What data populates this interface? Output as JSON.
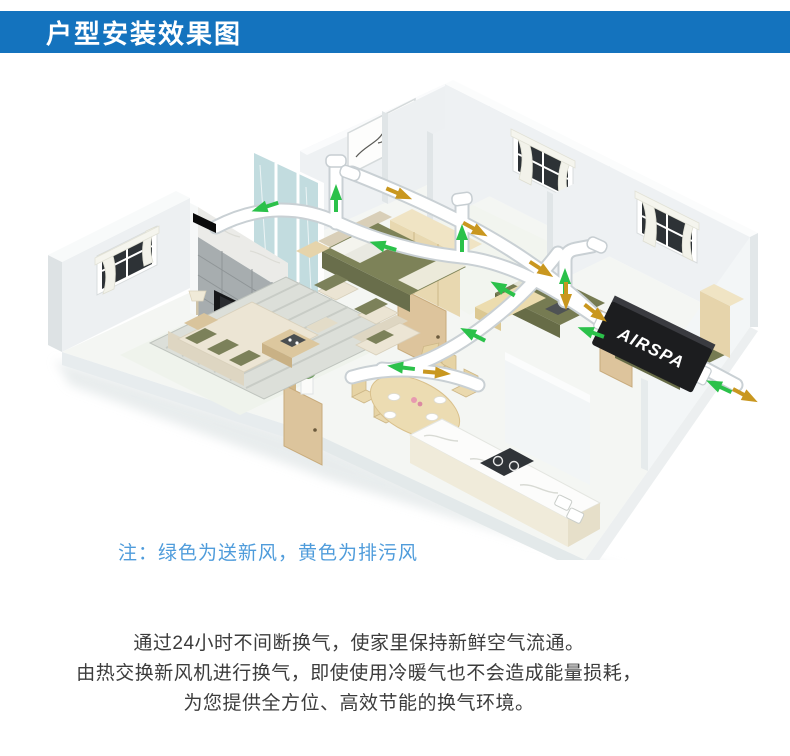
{
  "header": {
    "title": "户型安装效果图",
    "bg_color": "#1473be",
    "text_color": "#ffffff"
  },
  "illustration": {
    "type": "isometric-apartment-ventilation-cutaway",
    "unit_label": "AIRSPA",
    "airflow_legend": {
      "fresh_air": {
        "meaning": "送新风",
        "color": "#2bc14a"
      },
      "exhaust_air": {
        "meaning": "排污风",
        "color": "#c9971f"
      }
    }
  },
  "note": {
    "text": "注：绿色为送新风，黄色为排污风",
    "color": "#4f9cdb"
  },
  "description": {
    "lines": [
      "通过24小时不间断换气，使家里保持新鲜空气流通。",
      "由热交换新风机进行换气，即使使用冷暖气也不会造成能量损耗，",
      "为您提供全方位、高效节能的换气环境。"
    ],
    "color": "#3c3c3c"
  },
  "colors": {
    "header_blue": "#1473be",
    "note_blue": "#4f9cdb",
    "fresh_air_green": "#2bc14a",
    "exhaust_yellow": "#c9971f",
    "wall": "#eef1f3",
    "floor": "#f4f6f3",
    "wood": "#e6d4ab",
    "olive": "#7c815a"
  }
}
